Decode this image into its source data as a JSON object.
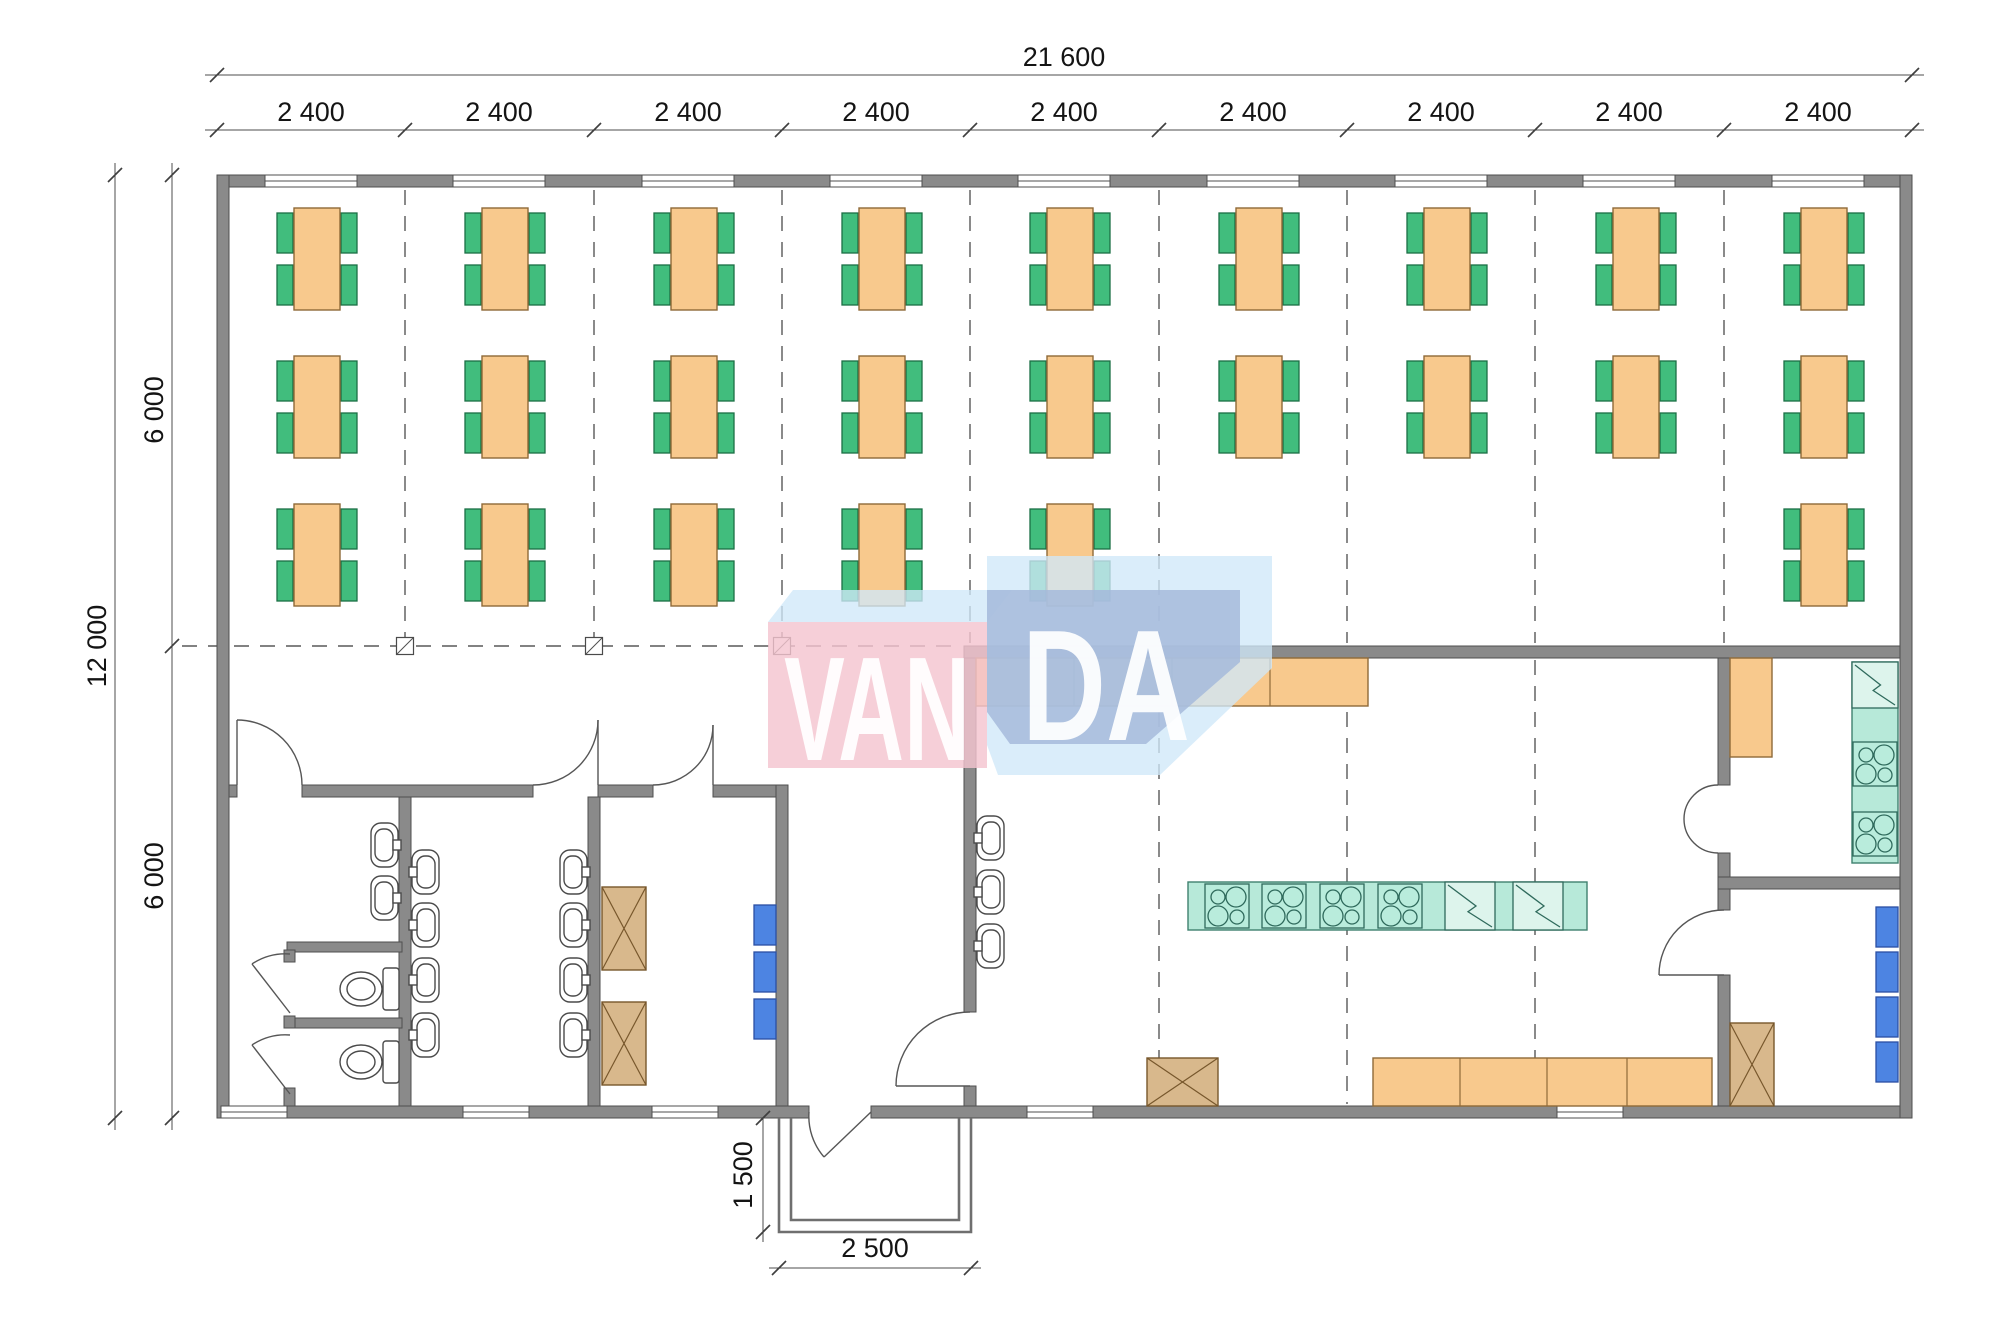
{
  "watermark": {
    "left": "VAN",
    "right": "DA"
  },
  "colors": {
    "wall": "#8a8a8a",
    "table": "#f8c98d",
    "chair": "#41bd7d",
    "appliance_teal": "#b7e9d9",
    "locker_blue": "#4d84e2",
    "storage_brown": "#d8b88c",
    "watermark_pink": "#f4c4d0",
    "watermark_steel": "#a3b8db",
    "watermark_light": "#d0e8f8"
  },
  "dims": {
    "top_total": {
      "label": "21 600",
      "y": 75,
      "x1": 217,
      "x2": 1912,
      "label_x": 1064,
      "label_y": 66
    },
    "bays": {
      "labels": [
        "2 400",
        "2 400",
        "2 400",
        "2 400",
        "2 400",
        "2 400",
        "2 400",
        "2 400",
        "2 400"
      ],
      "y": 130,
      "ticks": [
        217,
        405,
        594,
        782,
        970,
        1159,
        1347,
        1535,
        1724,
        1912
      ],
      "label_xs": [
        311,
        499,
        688,
        876,
        1064,
        1253,
        1441,
        1629,
        1818
      ],
      "label_y": 121
    },
    "left_total": {
      "label": "12 000",
      "x": 115,
      "y1": 175,
      "y2": 1118,
      "label_x": 106,
      "label_y": 646
    },
    "left_segs": {
      "labels": [
        "6 000",
        "6 000"
      ],
      "x": 172,
      "ticks": [
        175,
        646,
        1118
      ],
      "label_x": 163,
      "label_ys": [
        410,
        876
      ]
    },
    "porch_depth": {
      "label": "1 500",
      "x": 763,
      "y1": 1118,
      "y2": 1232,
      "label_x": 752,
      "label_y": 1175
    },
    "porch_width": {
      "label": "2 500",
      "y": 1268,
      "x1": 779,
      "x2": 971,
      "label_x": 875,
      "label_y": 1257
    }
  },
  "plan": {
    "tables": {
      "row_y": [
        259,
        407,
        555
      ],
      "positions": [
        [
          317,
          259
        ],
        [
          505,
          259
        ],
        [
          694,
          259
        ],
        [
          882,
          259
        ],
        [
          1070,
          259
        ],
        [
          1259,
          259
        ],
        [
          1447,
          259
        ],
        [
          1636,
          259
        ],
        [
          1824,
          259
        ],
        [
          317,
          407
        ],
        [
          505,
          407
        ],
        [
          694,
          407
        ],
        [
          882,
          407
        ],
        [
          1070,
          407
        ],
        [
          1259,
          407
        ],
        [
          1447,
          407
        ],
        [
          1636,
          407
        ],
        [
          1824,
          407
        ],
        [
          317,
          555
        ],
        [
          505,
          555
        ],
        [
          694,
          555
        ],
        [
          882,
          555
        ],
        [
          1070,
          555
        ],
        [
          1824,
          555
        ]
      ]
    },
    "windows_top": {
      "centers": [
        311,
        499,
        688,
        876,
        1064,
        1253,
        1441,
        1629,
        1818
      ],
      "y": 175,
      "w": 92
    },
    "windows_bottom": {
      "centers": [
        254,
        496,
        685,
        1060,
        1590
      ],
      "y": 1106,
      "w": 66
    },
    "grid_upper": {
      "xs": [
        405,
        594,
        782,
        970,
        1159,
        1347,
        1535,
        1724
      ],
      "y1": 190,
      "y2": 643
    },
    "grid_lower": {
      "xs": [
        1159,
        1347,
        1535
      ],
      "y1": 660,
      "y2": 1104
    },
    "grid_mid": {
      "y": 646,
      "x1": 182,
      "x2": 962
    },
    "column_markers": [
      405,
      594,
      782
    ],
    "counters": [
      {
        "x": 976,
        "y": 658,
        "w": 392,
        "h": 48,
        "divs": [
          1074,
          1172,
          1270
        ]
      },
      {
        "x": 1373,
        "y": 1058,
        "w": 339,
        "h": 48,
        "divs": [
          1460,
          1547,
          1627
        ]
      },
      {
        "x": 1730,
        "y": 658,
        "w": 42,
        "h": 99,
        "divs": []
      }
    ],
    "appliance_bases": [
      {
        "x": 1188,
        "y": 882,
        "w": 399,
        "h": 48
      },
      {
        "x": 1852,
        "y": 662,
        "w": 46,
        "h": 201
      }
    ],
    "stoves": [
      {
        "x": 1205,
        "y": 884,
        "s": 44
      },
      {
        "x": 1262,
        "y": 884,
        "s": 44
      },
      {
        "x": 1320,
        "y": 884,
        "s": 44
      },
      {
        "x": 1378,
        "y": 884,
        "s": 44
      },
      {
        "x": 1853,
        "y": 742,
        "s": 44
      },
      {
        "x": 1853,
        "y": 812,
        "s": 44
      }
    ],
    "fridges": [
      {
        "x": 1445,
        "y": 882,
        "w": 50,
        "h": 48
      },
      {
        "x": 1513,
        "y": 882,
        "w": 50,
        "h": 48
      },
      {
        "x": 1852,
        "y": 662,
        "w": 46,
        "h": 46
      }
    ],
    "lockers": [
      {
        "x": 754,
        "y": 905
      },
      {
        "x": 754,
        "y": 952
      },
      {
        "x": 754,
        "y": 999
      },
      {
        "x": 1876,
        "y": 907
      },
      {
        "x": 1876,
        "y": 952
      },
      {
        "x": 1876,
        "y": 997
      },
      {
        "x": 1876,
        "y": 1042
      }
    ],
    "storage_boxes": [
      {
        "x": 602,
        "y": 887,
        "w": 44,
        "h": 83
      },
      {
        "x": 602,
        "y": 1002,
        "w": 44,
        "h": 83
      },
      {
        "x": 1147,
        "y": 1058,
        "w": 71,
        "h": 48
      },
      {
        "x": 1730,
        "y": 1023,
        "w": 44,
        "h": 83
      }
    ],
    "sinks": [
      {
        "x": 399,
        "y": 845,
        "d": -1
      },
      {
        "x": 399,
        "y": 898,
        "d": -1
      },
      {
        "x": 411,
        "y": 872,
        "d": 1
      },
      {
        "x": 411,
        "y": 925,
        "d": 1
      },
      {
        "x": 411,
        "y": 980,
        "d": 1
      },
      {
        "x": 411,
        "y": 1035,
        "d": 1
      },
      {
        "x": 588,
        "y": 872,
        "d": -1
      },
      {
        "x": 588,
        "y": 925,
        "d": -1
      },
      {
        "x": 588,
        "y": 980,
        "d": -1
      },
      {
        "x": 588,
        "y": 1035,
        "d": -1
      },
      {
        "x": 976,
        "y": 838,
        "d": 1
      },
      {
        "x": 976,
        "y": 892,
        "d": 1
      },
      {
        "x": 976,
        "y": 946,
        "d": 1
      }
    ],
    "toilets": [
      {
        "x": 399,
        "y": 989
      },
      {
        "x": 399,
        "y": 1062
      }
    ]
  }
}
